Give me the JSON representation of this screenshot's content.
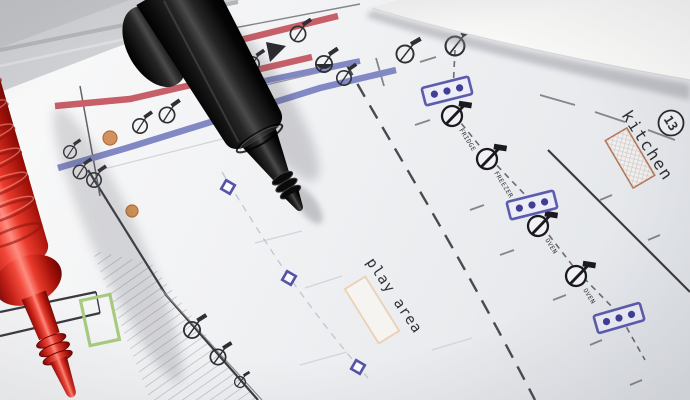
{
  "scene": {
    "kind": "photograph",
    "description": "Red and black multimeter test probes lying on an electrical floor-plan drawing, with a second white sheet overlapping the top-right corner",
    "objects": [
      {
        "name": "red test probe",
        "color": "#d62c22"
      },
      {
        "name": "black test probe",
        "color": "#141414"
      },
      {
        "name": "white paper sheet corner",
        "color": "#fafaf8"
      },
      {
        "name": "electrical floor plan drawing",
        "color": "#f1f2f4"
      }
    ]
  },
  "plan": {
    "room_labels": [
      {
        "text": "kitchen"
      },
      {
        "text": "play area"
      }
    ],
    "circle_note": {
      "number": "13"
    },
    "appliance_labels": [
      {
        "text": "FRIDGE"
      },
      {
        "text": "FREEZER"
      },
      {
        "text": "OVEN"
      },
      {
        "text": "OVEN"
      }
    ],
    "symbols": {
      "lighting_point": "circle with diagonal stem",
      "triple_socket": "blue rectangle with three dots",
      "junction_box": "small blue square",
      "door": "green rectangle outline",
      "stairs": "hatched band"
    },
    "colors": {
      "red_circuit_run": "#c75f68",
      "blue_circuit_run": "#8288c4",
      "socket_blue": "#5c5cae",
      "kitchen_hatch_border": "#b5795c",
      "play_area_border": "#ecd0b4",
      "door_green": "#a9cb80",
      "ink": "#2e2e33"
    }
  }
}
